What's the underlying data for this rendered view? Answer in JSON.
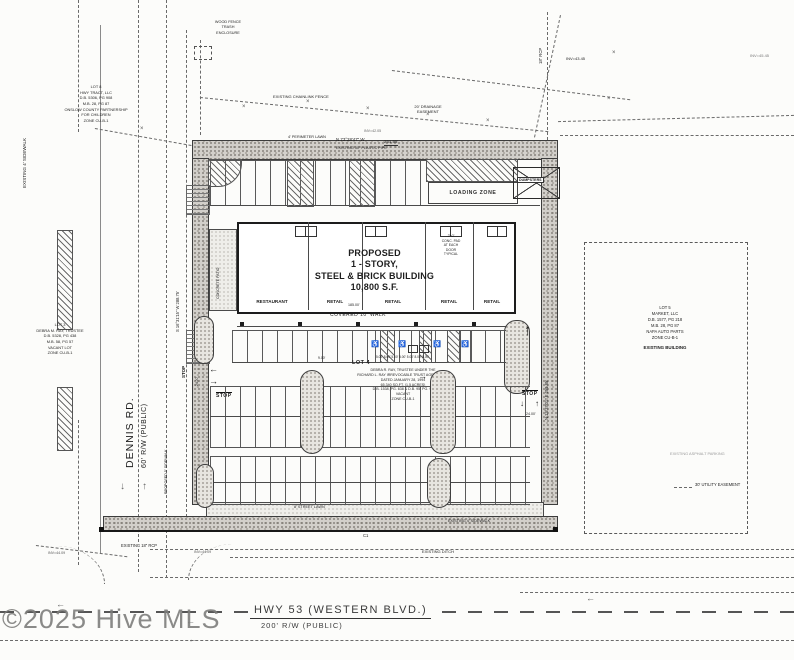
{
  "watermark": "©2025 Hive MLS",
  "roads": {
    "dennis_name": "DENNIS RD.",
    "dennis_rw": "60' R/W (PUBLIC)",
    "hwy_name": "HWY 53 (WESTERN BLVD.)",
    "hwy_rw": "200' R/W (PUBLIC)"
  },
  "building": {
    "title": [
      "PROPOSED",
      "1 - STORY,",
      "STEEL & BRICK BUILDING",
      "10,800 S.F."
    ],
    "units": [
      "RESTAURANT",
      "RETAIL",
      "RETAIL",
      "RETAIL",
      "RETAIL"
    ],
    "covered_walk": "COVERED 10' WALK",
    "conc_pad_note": [
      "2'x2'",
      "CONC. PAD",
      "AT EACH",
      "DOOR",
      "TYPICAL"
    ],
    "patio": "CONCRETE PATIO"
  },
  "lots": {
    "lot8": [
      "LOT 8",
      "HWY TRACT, LLC",
      "D.B. 5306, PG 908",
      "M.B. 28, PG 87",
      "ONSLOW COUNTY PARTNERSHIP",
      "FOR CHILDREN",
      "ZONE CU-B-1"
    ],
    "lot3": [
      "LOT 3",
      "DEBRA M. RAY, TRUSTEE",
      "D.B. 5328, PG 438",
      "M.B. 58, PG 57",
      "VACANT LOT",
      "ZONE CU-B-1"
    ],
    "lot4_title": "LOT 4",
    "lot4": [
      "DEBRA R. RAY, TRUSTEE UNDER THE",
      "RICHARD L. RAY IRREVOCABLE TRUST AGREEMENT",
      "DATED JANUARY 28, 1994",
      "65,340 SQ.FT. (1.5 ACRES)",
      "D.B. 1538, PG. 638 & D.B. 95, PG. 97",
      "VACANT",
      "ZONE CU-B-1"
    ],
    "lot5": [
      "LOT 5",
      "MARKET, LLC",
      "D.B. 1577, PG 218",
      "M.B. 28, PG 87",
      "NAPA AUTO PARTS",
      "ZONE CU-B-1"
    ],
    "lot5_building": "EXISTING BUILDING"
  },
  "bearings": {
    "top": "N 73°28'47\" W",
    "top_dist": "261.95'",
    "west": "S 16°31'15\" W  288.75'",
    "east": "N 13°37'01\" E  259.85'"
  },
  "labels": {
    "loading_zone": "LOADING ZONE",
    "dumpsters": "DUMPSTERS",
    "stop": "STOP",
    "chainlink_fence": "EXISTING CHAINLINK FENCE",
    "drainage_easement": [
      "20' DRAINAGE",
      "EASEMENT"
    ],
    "wood_fence": [
      "WOOD FENCE",
      "TRASH",
      "ENCLOSURE"
    ],
    "plastic_pipe": "EXISTING 30\" PLASTIC PIPE",
    "perimeter_lawn": "4' PERIMETER LAWN",
    "existing_sidewalk_w": "EXISTING 4' SIDEWALK",
    "existing_sidewalk_s": "EXISTING 4' SIDEWALK",
    "proposed_sidewalk": "PROPOSED 5' SIDEWALK",
    "street_lawn": "8' STREET LAWN",
    "existing_ditch": "EXISTING DITCH",
    "existing_rcp": "EXISTING 18\" RCP",
    "rcp_ne": "18\" RCP",
    "utility_easement": "30' UTILITY EASEMENT",
    "existing_asphalt": "EXISTING ASPHALT PARKING",
    "c1": "C1",
    "inv_4205": "INV=42.05",
    "inv_4345": "INV=43.45",
    "inv_4409": "INV=44.09",
    "inv_4545": "INV=45.45"
  },
  "dims": {
    "d185": "185.00'",
    "d24": "24.00'",
    "d9": "9.00'",
    "hc_row": "5.00' 8.00' 5.00'  5.00'  5.00' 8.00' 5.00'"
  },
  "glyphs": {
    "x": "×",
    "arrow_left": "←",
    "arrow_right": "→",
    "arrow_up": "↑",
    "arrow_down": "↓",
    "wheelchair": "♿"
  }
}
